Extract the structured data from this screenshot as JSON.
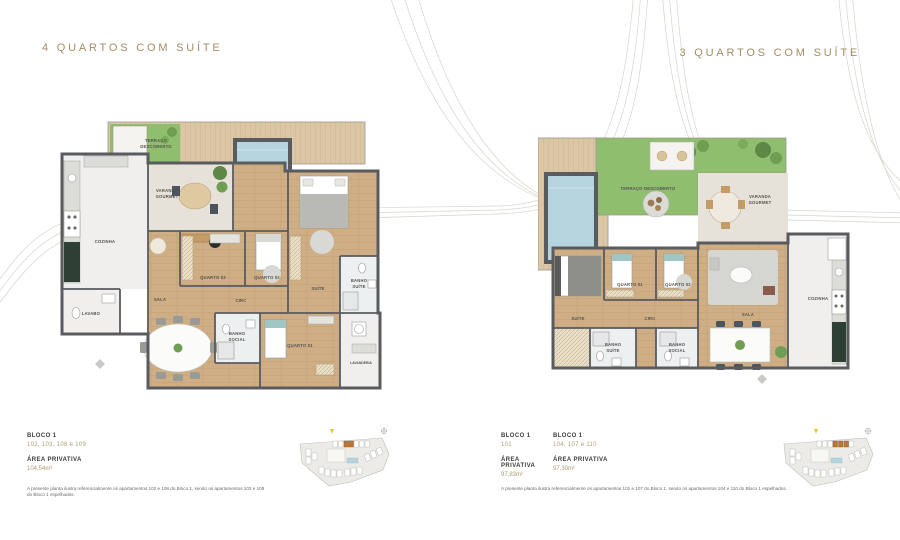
{
  "headers": {
    "left": "4 QUARTOS COM SUÍTE",
    "right": "3 QUARTOS COM SUÍTE"
  },
  "left_plan": {
    "labels": {
      "terraco_l1": "TERRAÇO",
      "terraco_l2": "DESCOBERTO",
      "varanda_l1": "VARANDA",
      "varanda_l2": "GOURMET",
      "cozinha": "COZINHA",
      "lavabo": "LAVABO",
      "sala": "SALA",
      "quarto3": "QUARTO 03",
      "quarto2": "QUARTO 02",
      "suite": "SUÍTE",
      "banho_suite_l1": "BANHO",
      "banho_suite_l2": "SUÍTE",
      "circ": "CIRC",
      "banho_social_l1": "BANHO",
      "banho_social_l2": "SOCIAL",
      "quarto1": "QUARTO 01",
      "lavanderia": "LAVANDERIA"
    }
  },
  "right_plan": {
    "labels": {
      "terraco": "TERRAÇO DESCOBERTO",
      "varanda_l1": "VARANDA",
      "varanda_l2": "GOURMET",
      "cozinha": "COZINHA",
      "sala": "SALA",
      "suite": "SUÍTE",
      "quarto1": "QUARTO 01",
      "quarto2": "QUARTO 02",
      "circ": "CIRC",
      "banho_suite_l1": "BANHO",
      "banho_suite_l2": "SUÍTE",
      "banho_social_l1": "BANHO",
      "banho_social_l2": "SOCIAL"
    }
  },
  "left_info": {
    "bloco_label": "BLOCO 1",
    "units": "102, 103, 108 e 109",
    "area_label": "ÁREA PRIVATIVA",
    "area_value": "104,54m²",
    "disclaimer": "A presente planta ilustra referencialmente os apartamentos 102 e 108 do Bloco 1, sendo os apartamentos 103 e 109 do Bloco 1 espelhados."
  },
  "right_info": {
    "col1": {
      "bloco_label": "BLOCO 1",
      "units": "101",
      "area_label": "ÁREA PRIVATIVA",
      "area_value": "97,83m²"
    },
    "col2": {
      "bloco_label": "BLOCO 1",
      "units": "104, 107 e 110",
      "area_label": "ÁREA PRIVATIVA",
      "area_value": "97,30m²"
    },
    "disclaimer": "A presente planta ilustra referencialmente os apartamentos 101 e 107 do Bloco 1, sendo os apartamentos 104 e 110 do Bloco 1 espelhados."
  },
  "colors": {
    "accent_gold": "#a28d64",
    "wall_gray": "#595b5f",
    "wood_floor": "#cfae85",
    "grass_green": "#8fbe6e",
    "pool_blue": "#b5d4de",
    "deck_tan": "#dbc7a6",
    "keyplan_highlight": "#b5773d"
  }
}
